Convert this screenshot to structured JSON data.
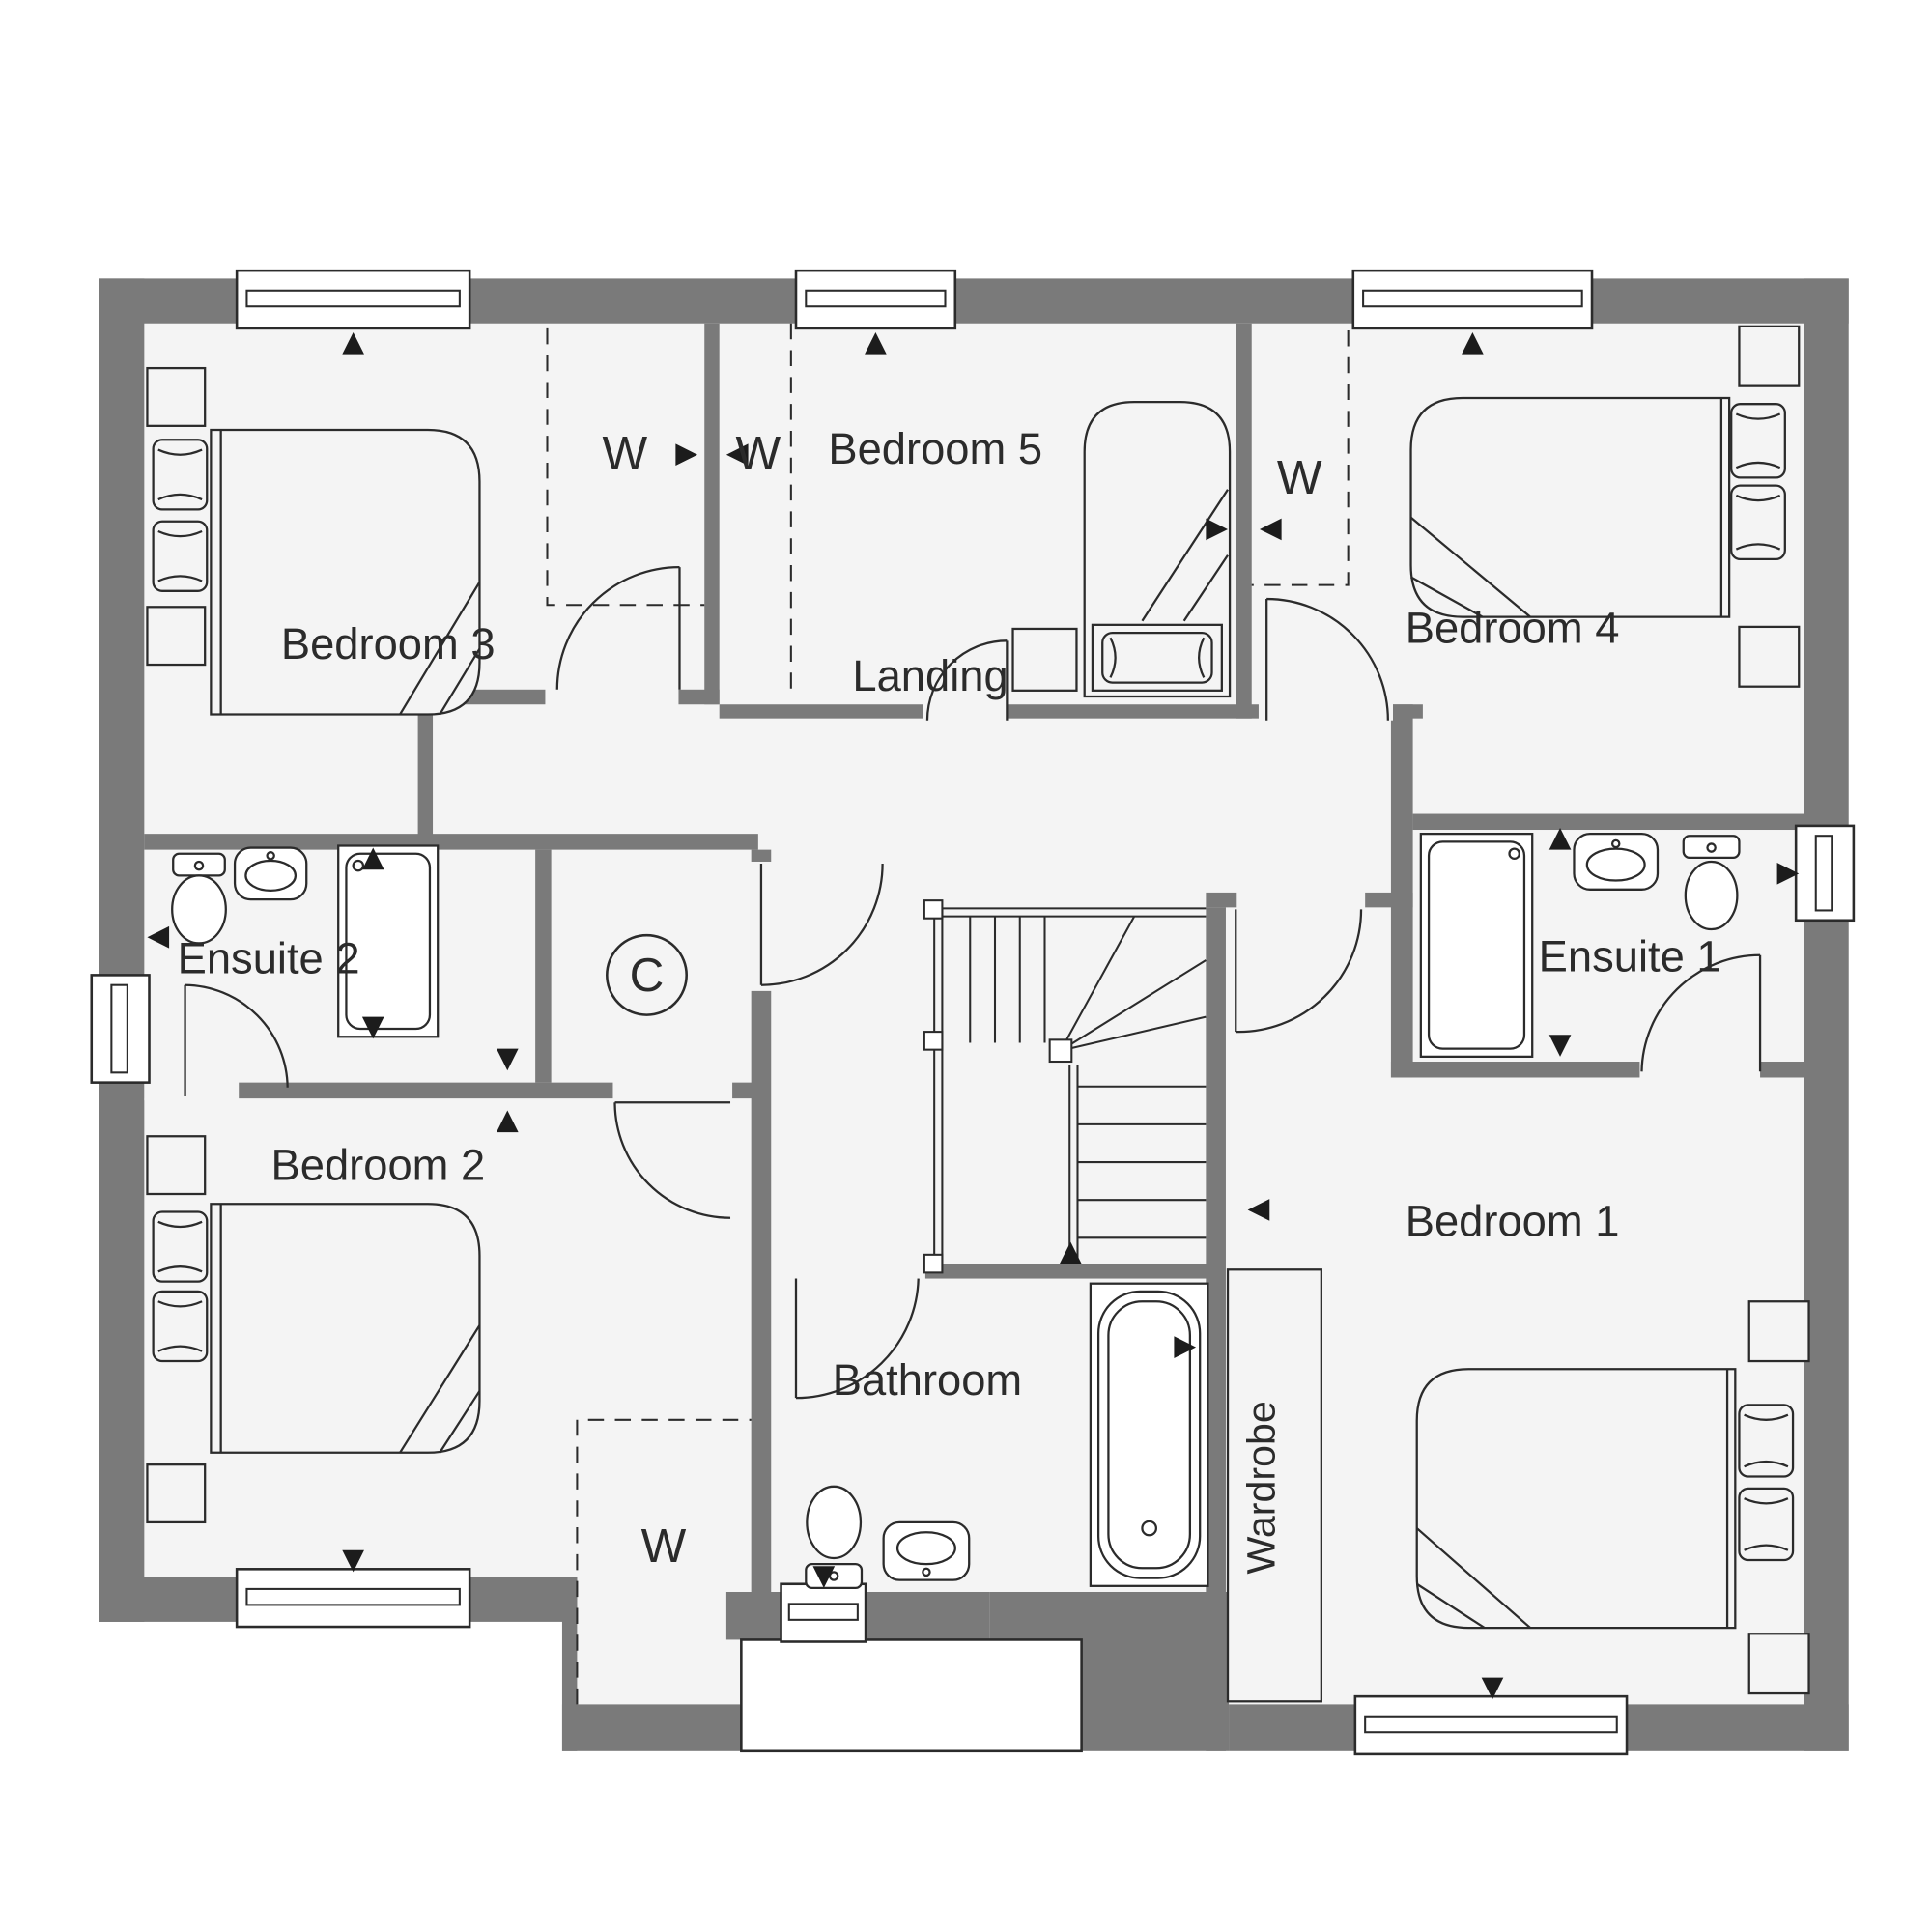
{
  "plan_title": "First floor plan",
  "labels": {
    "bedroom1": "Bedroom 1",
    "bedroom2": "Bedroom 2",
    "bedroom3": "Bedroom 3",
    "bedroom4": "Bedroom 4",
    "bedroom5": "Bedroom 5",
    "ensuite1": "Ensuite 1",
    "ensuite2": "Ensuite 2",
    "bathroom": "Bathroom",
    "landing": "Landing",
    "wardrobe": "Wardrobe",
    "wardrobe_letter": "W",
    "cupboard_letter": "C"
  },
  "colors": {
    "wall": "#7a7a7a",
    "floor": "#f4f4f4",
    "line": "#2b2b2b",
    "background": "#ffffff"
  },
  "icons": {
    "window": "double-line window symbol",
    "door": "quarter-circle swing",
    "arrow": "solid triangle marker",
    "stairs": "winder staircase with rails"
  }
}
